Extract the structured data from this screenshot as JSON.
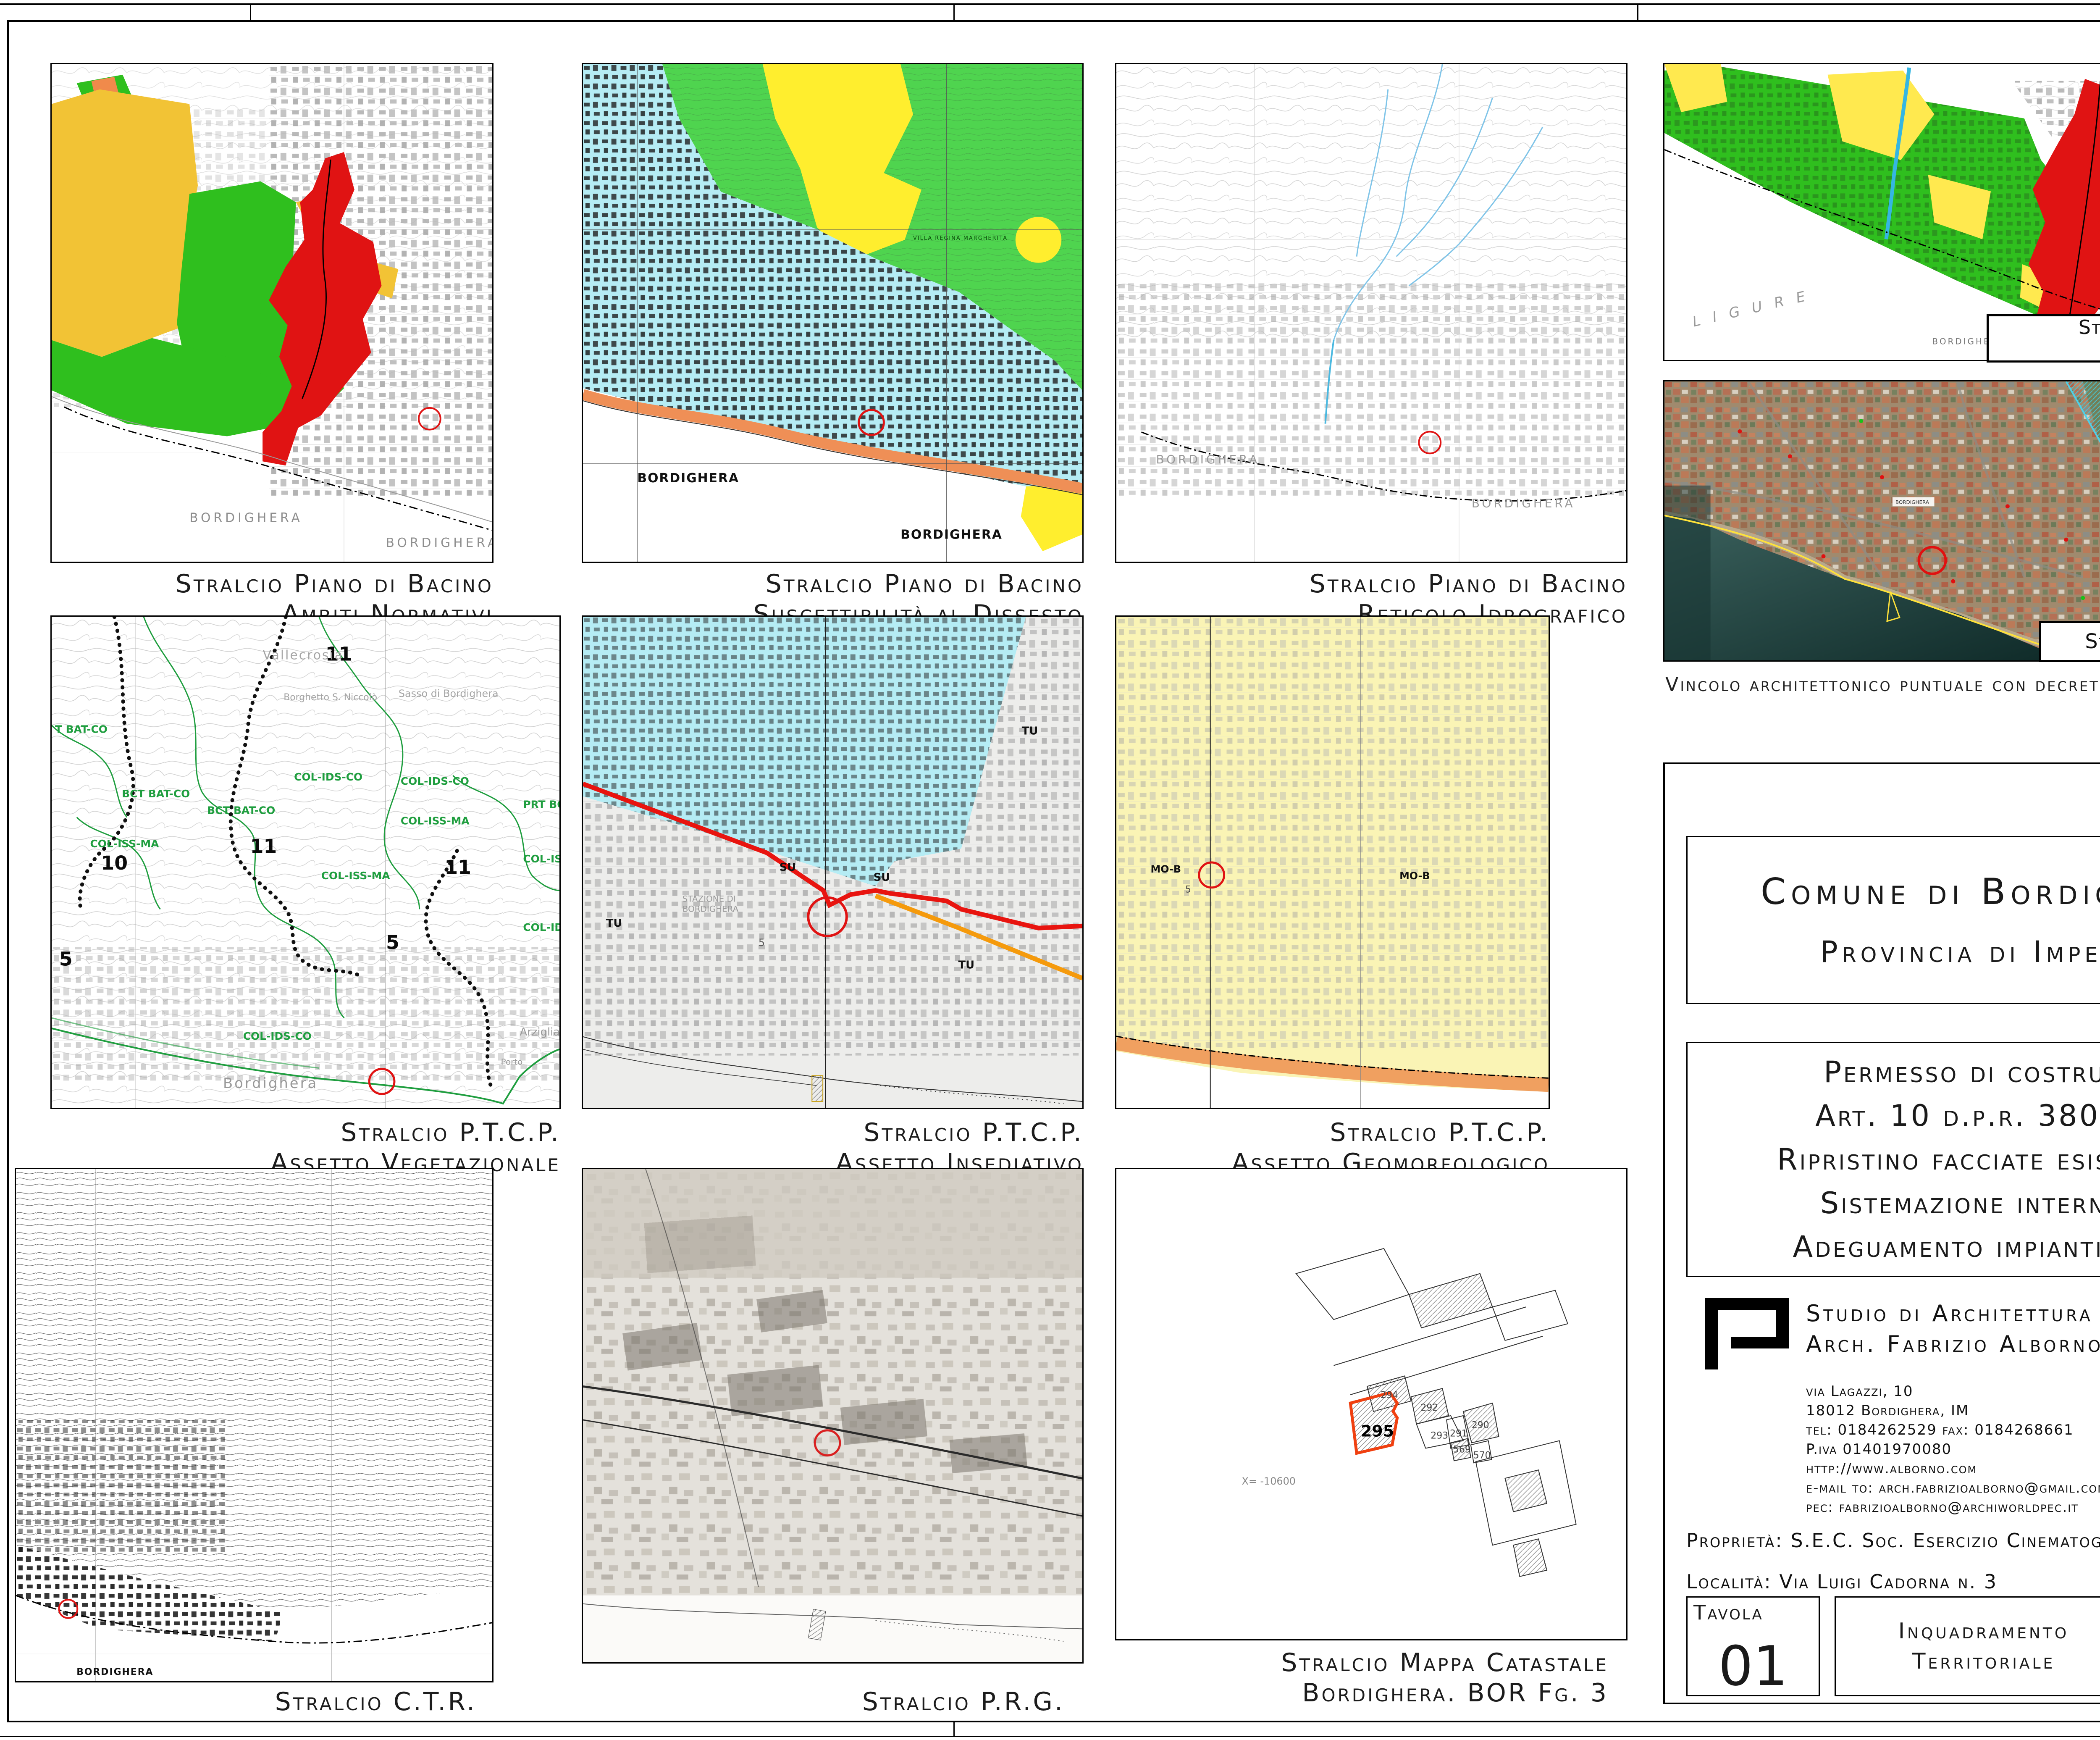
{
  "panels": {
    "ambiti": {
      "caption_line1": "Stralcio Piano di Bacino",
      "caption_line2": "Ambiti Normativi",
      "labels": {
        "city1": "BORDIGHERA",
        "city2": "BORDIGHERA"
      }
    },
    "suscettibilita": {
      "caption_line1": "Stralcio Piano di Bacino",
      "caption_line2": "Suscettibilità al Dissesto",
      "labels": {
        "city1": "BORDIGHERA",
        "city2": "BORDIGHERA",
        "villa": "VILLA REGINA MARGHERITA"
      }
    },
    "reticolo": {
      "caption_line1": "Stralcio Piano di Bacino",
      "caption_line2": "Reticolo Idrografico",
      "labels": {
        "city1": "BORDIGHERA",
        "city2": "BORDIGHERA"
      }
    },
    "fasce": {
      "caption_line1": "Stralcio Piano di Bacino",
      "caption_line2": "Fasce Innondabili",
      "labels": {
        "sea": "LIGURE",
        "city": "BORDIGHERA"
      }
    },
    "vincoli": {
      "caption": "Stralcio Carta Vincoli",
      "note": "Vincolo architettonico puntuale con decreto",
      "labels": {
        "city1": "BORDIGHERA",
        "city2": "BORDIGHERA"
      }
    },
    "vegetazionale": {
      "caption_line1": "Stralcio P.T.C.P.",
      "caption_line2": "Assetto Vegetazionale",
      "numbers": {
        "n11a": "11",
        "n10": "10",
        "n11b": "11",
        "n11c": "11",
        "n5a": "5",
        "n5b": "5"
      },
      "zones": {
        "z1": "T BAT-CO",
        "z2": "BCT BAT-CO",
        "z3": "BCT BAT-CO",
        "z4": "COL-IDS-CO",
        "z5": "COL-IDS-CO",
        "z6": "COL-ISS-MA",
        "z7": "COL-ISS-MA",
        "z8": "COL-ISS-MA",
        "z9": "PRT BO",
        "z10": "COL-ISS-M",
        "z11": "COL-IDS-C",
        "z12": "COL-IDS-CO"
      },
      "places": {
        "vallecrosia": "Vallecrosia",
        "borghetto": "Borghetto S. Niccolò",
        "sasso": "Sasso di Bordighera",
        "city": "Bordighera",
        "arziglia": "Arziglia",
        "porto": "Porto"
      }
    },
    "insediativo": {
      "caption_line1": "Stralcio P.T.C.P.",
      "caption_line2": "Assetto Insediativo",
      "labels": {
        "su1": "SU",
        "su2": "SU",
        "tu1": "TU",
        "tu2": "TU",
        "tu3": "TU",
        "n5": "5",
        "station1": "STAZIONE DI",
        "station2": "BORDIGHERA"
      }
    },
    "geomorfologico": {
      "caption_line1": "Stralcio P.T.C.P.",
      "caption_line2": "Assetto Geomorfologico",
      "labels": {
        "mo1": "MO-B",
        "mo2": "MO-B",
        "n5": "5"
      }
    },
    "ctr": {
      "caption": "Stralcio C.T.R.",
      "labels": {
        "city": "BORDIGHERA"
      }
    },
    "prg": {
      "caption": "Stralcio P.R.G."
    },
    "catastale": {
      "caption_line1": "Stralcio Mappa Catastale",
      "caption_line2": "Bordighera. BOR Fg. 3",
      "parcels": {
        "p294": "294",
        "p292": "292",
        "p293": "293",
        "p295": "295",
        "p291": "291",
        "p290": "290",
        "p569": "569",
        "p570": "570"
      },
      "coord": "X= -10600"
    }
  },
  "title_block": {
    "municipality_line1": "Comune di Bordighera",
    "municipality_line2": "Provincia di Imperia",
    "permit_lines": [
      "Permesso di costruire",
      "Art. 10 d.p.r. 380/01",
      "Ripristino facciate esistenti,",
      "Sistemazione interna e",
      "Adeguamento impiantistico"
    ],
    "studio_line1": "Studio di Architettura",
    "studio_line2": "Arch. Fabrizio Alborno",
    "address_lines": [
      "via Lagazzi, 10",
      "18012 Bordighera, IM",
      "tel: 0184262529 fax: 0184268661",
      "P.iva 01401970080",
      "http://www.alborno.com",
      "e-mail to: arch.fabrizioalborno@gmail.com",
      "pec: fabrizioalborno@archiworldpec.it"
    ],
    "property": "Proprietà: S.E.C. Soc. Esercizio Cinematografia",
    "location": "Località: Via Luigi Cadorna n. 3",
    "tavola_label": "Tavola",
    "tavola_number": "01",
    "drawing_title_line1": "Inquadramento",
    "drawing_title_line2": "Territoriale",
    "scala_label": "Scala:",
    "data_label": "Data:",
    "data_value": "01/04/19"
  },
  "colors": {
    "zone_red": "#e01313",
    "zone_green": "#2fbf1e",
    "zone_yellow": "#ffe94f",
    "zone_amber": "#f2c335",
    "zone_cyan": "#b5ecf4",
    "coast_orange": "#ef8f56",
    "stream_blue": "#35b6e2",
    "boundary_green": "#1f9e3f",
    "marker_red": "#e01313",
    "pale_yellow": "#faf4b5",
    "band_orange": "#f0a060",
    "line_red": "#e8140f",
    "line_orange": "#f59a0c"
  }
}
